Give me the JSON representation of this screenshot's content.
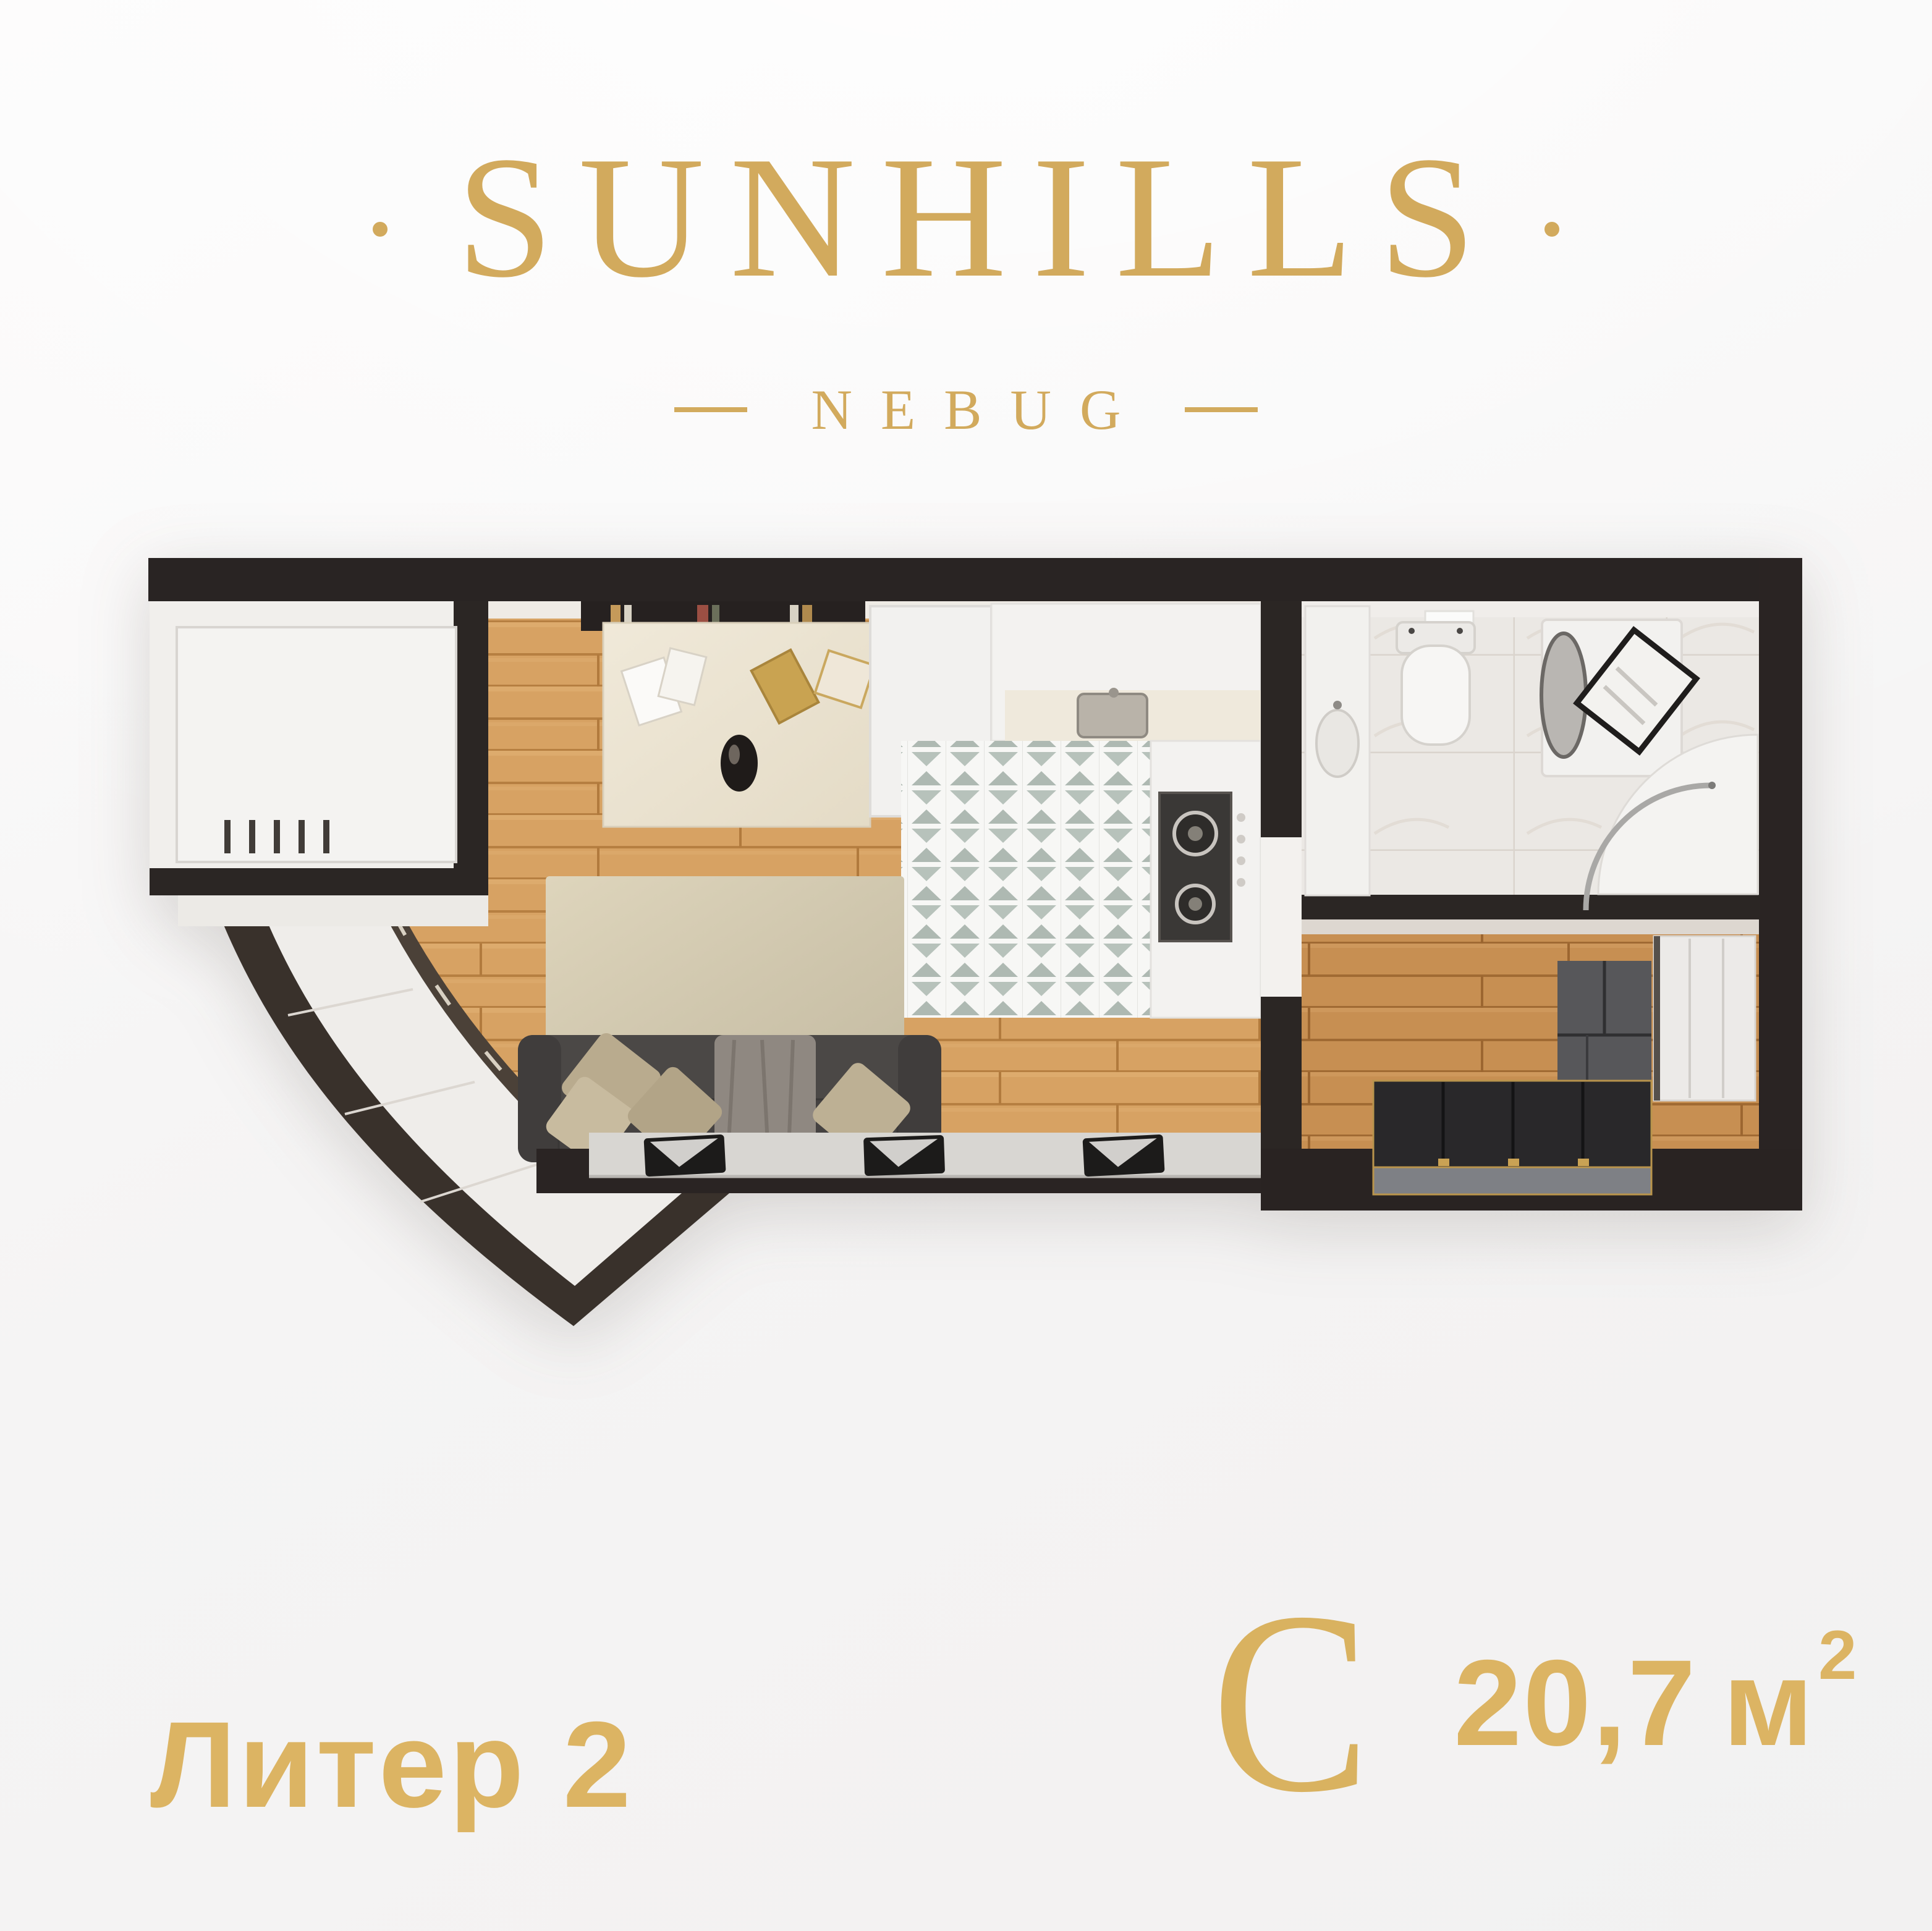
{
  "brand": {
    "name": "SUNHILLS",
    "location": "NEBUG"
  },
  "labels": {
    "building": "Литер 2",
    "unit_type_letter": "С",
    "area_value": "20,7",
    "area_unit_letter": "м",
    "area_superscript": "2"
  },
  "colors": {
    "gold": "#d2aa5d",
    "gold_bold_text": "#dcb463",
    "wall_dark": "#2a2423",
    "balcony_wall": "#39312b",
    "window_wall": "#4b4138",
    "wood_living": "#d7a263",
    "wood_bedroom": "#c78f52",
    "kitchen_tile_accent": "#b7c2bb",
    "marble_floor": "#ebe8e4",
    "sofa": "#4b4846",
    "bed": "#29282a",
    "background": "#f5f4f4"
  },
  "floorplan": {
    "rooms": [
      {
        "name": "balcony-curved"
      },
      {
        "name": "entry-nook"
      },
      {
        "name": "living-room-with-kitchen"
      },
      {
        "name": "bathroom"
      },
      {
        "name": "bedroom"
      }
    ],
    "furniture": [
      "wardrobe-cabinet-entry",
      "air-conditioner-vent",
      "book-shelf",
      "desk",
      "decor-vase",
      "tall-cabinet",
      "kitchen-counter",
      "kitchen-sink",
      "gas-stove",
      "kitchen-tile-floor",
      "living-rug",
      "sofa",
      "pillows",
      "throw-blanket",
      "media-ledge",
      "laptop",
      "laptop",
      "laptop",
      "bathroom-vanity",
      "toilet",
      "washing-machine",
      "laundry-basket",
      "shower-cabin",
      "bedroom-rug",
      "double-bed",
      "wardrobe-bedroom"
    ]
  }
}
